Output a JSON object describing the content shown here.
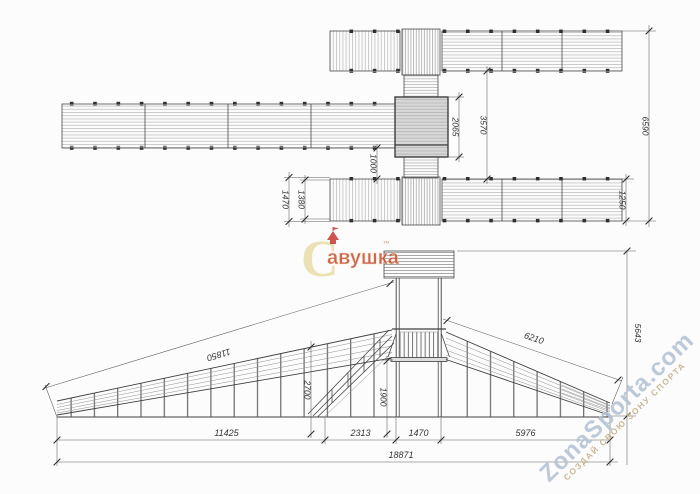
{
  "drawing": {
    "plan": {
      "dims": {
        "platform_depth": "2065",
        "walkway_gap": "3570",
        "walkway_offset": "1000",
        "overall_width": "6590",
        "walkway_width": "1250",
        "ramp_width_outer": "1470",
        "ramp_width_inner": "1380"
      }
    },
    "elevation": {
      "dims": {
        "left_ramp_slope": "11850",
        "right_ramp_slope": "6210",
        "rail_height": "2700",
        "platform_height": "1900",
        "overall_height": "5643",
        "left_run": "11425",
        "stair_run": "2313",
        "tower_width": "1470",
        "right_run": "5976",
        "overall_run": "18871"
      }
    }
  },
  "watermarks": {
    "logo": {
      "initial": "С",
      "rest": "авушка",
      "trademark": "™"
    },
    "site": "ZonaSporta.com",
    "slogan": "СОЗДАЙ СВОЮ ЗОНУ СПОРТА"
  }
}
